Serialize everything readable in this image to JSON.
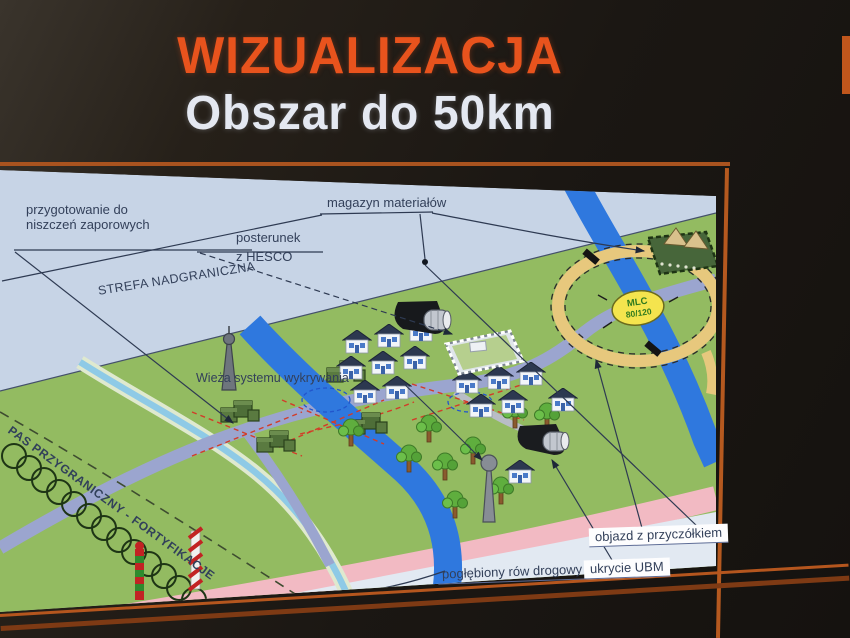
{
  "slide": {
    "title": "WIZUALIZACJA",
    "subtitle": "Obszar do 50km"
  },
  "map": {
    "labels": {
      "preparation_line1": "przygotowanie do",
      "preparation_line2": "niszczeń zaporowych",
      "checkpoint_line1": "posterunek",
      "checkpoint_line2": "z HESCO",
      "depot": "magazyn materiałów",
      "border_zone": "STREFA NADGRANICZNA",
      "tower": "Wieża systemu wykrywania",
      "border_strip": "PAS PRZYGRANICZNY - FORTYFIKACJE",
      "detour": "objazd z przyczółkiem",
      "shelter": "ukrycie UBM",
      "ditch": "pogłębiony rów drogowy"
    },
    "bridge_badge": {
      "line1": "MLC",
      "line2": "80/120"
    },
    "colors": {
      "title_accent": "#e8531d",
      "frame_orange": "#b5561e",
      "terrain_green": "#93bb61",
      "sky_blue": "#c7d4e6",
      "river_blue": "#2f78de",
      "road_lavender": "#9ba5cf",
      "detour_tan": "#e7c87d",
      "border_road_pink": "#f2bac3",
      "badge_yellow": "#f4e44e"
    },
    "features": [
      "concertina-wire",
      "border-posts",
      "detection-tower",
      "sensor-tower",
      "village-houses",
      "hesco-compound",
      "materials-depot-tents",
      "ubm-shelter",
      "mlc-bridge-crossing",
      "detour-ring",
      "rivers",
      "drainage-ditch",
      "demolition-marks"
    ]
  }
}
